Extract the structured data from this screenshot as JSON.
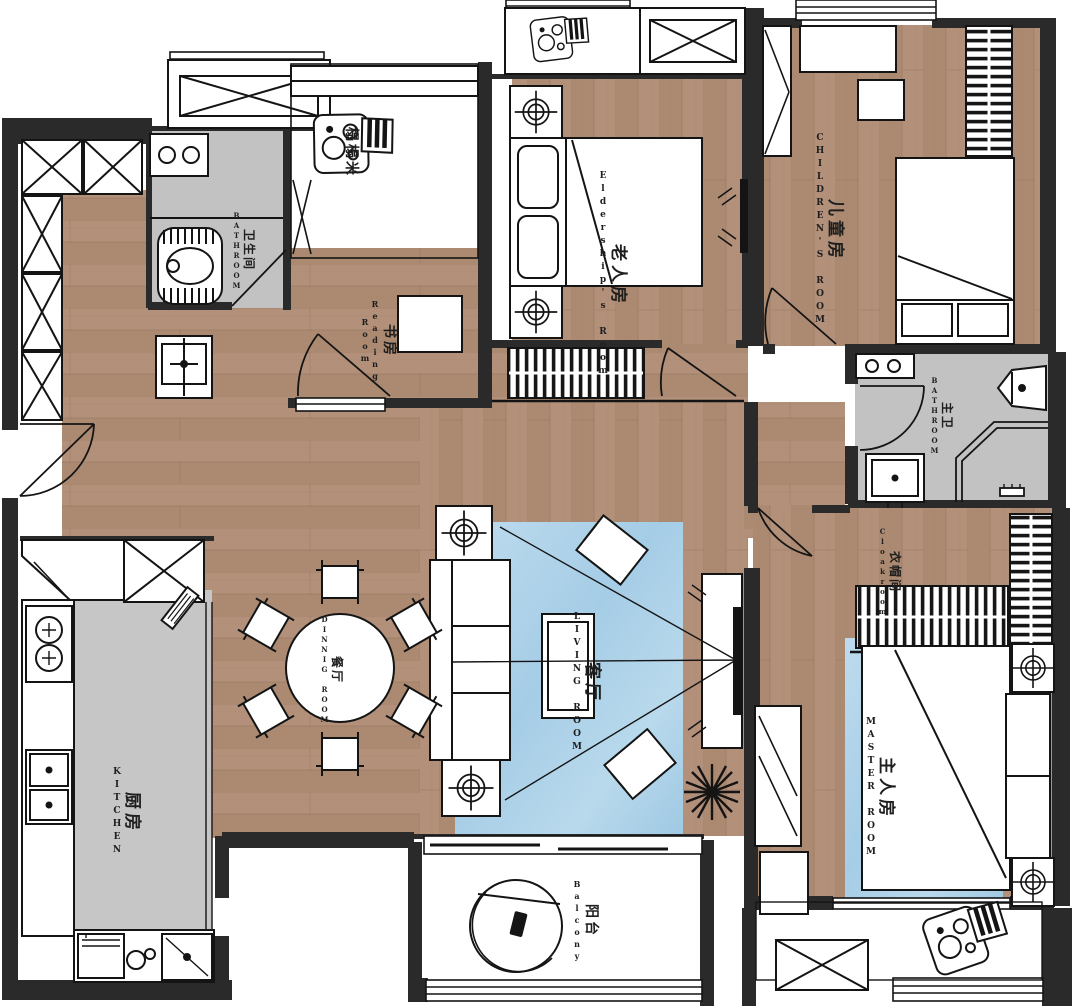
{
  "colors": {
    "wall": "#2a2a2a",
    "wood_floor": "#b2907a",
    "wood_floor_dark": "#a88368",
    "tile_gray": "#c2c2c2",
    "rug_blue": "#aed2e8",
    "line": "#1a1a1a",
    "paper": "#ffffff"
  },
  "rooms": {
    "guest_bath": {
      "zh": "卫生间",
      "en": "BATHROOM"
    },
    "tatami": {
      "zh": "榻榻米",
      "en": ""
    },
    "reading": {
      "zh": "书房",
      "en": "Reading Room"
    },
    "elderly": {
      "zh": "老人房",
      "en": "Eldership's Room"
    },
    "children": {
      "zh": "儿童房",
      "en": "CHILDREN'S ROOM"
    },
    "master_bath": {
      "zh": "主卫",
      "en": "BATHROOM"
    },
    "cloakroom": {
      "zh": "衣帽间",
      "en": "Cloakroom"
    },
    "master": {
      "zh": "主人房",
      "en": "MASTER ROOM"
    },
    "living": {
      "zh": "客厅",
      "en": "LIVING ROOM"
    },
    "dining": {
      "zh": "餐厅",
      "en": "DINNIG ROOM"
    },
    "kitchen": {
      "zh": "厨房",
      "en": "KITCHEN"
    },
    "balcony": {
      "zh": "阳台",
      "en": "Balcony"
    }
  }
}
